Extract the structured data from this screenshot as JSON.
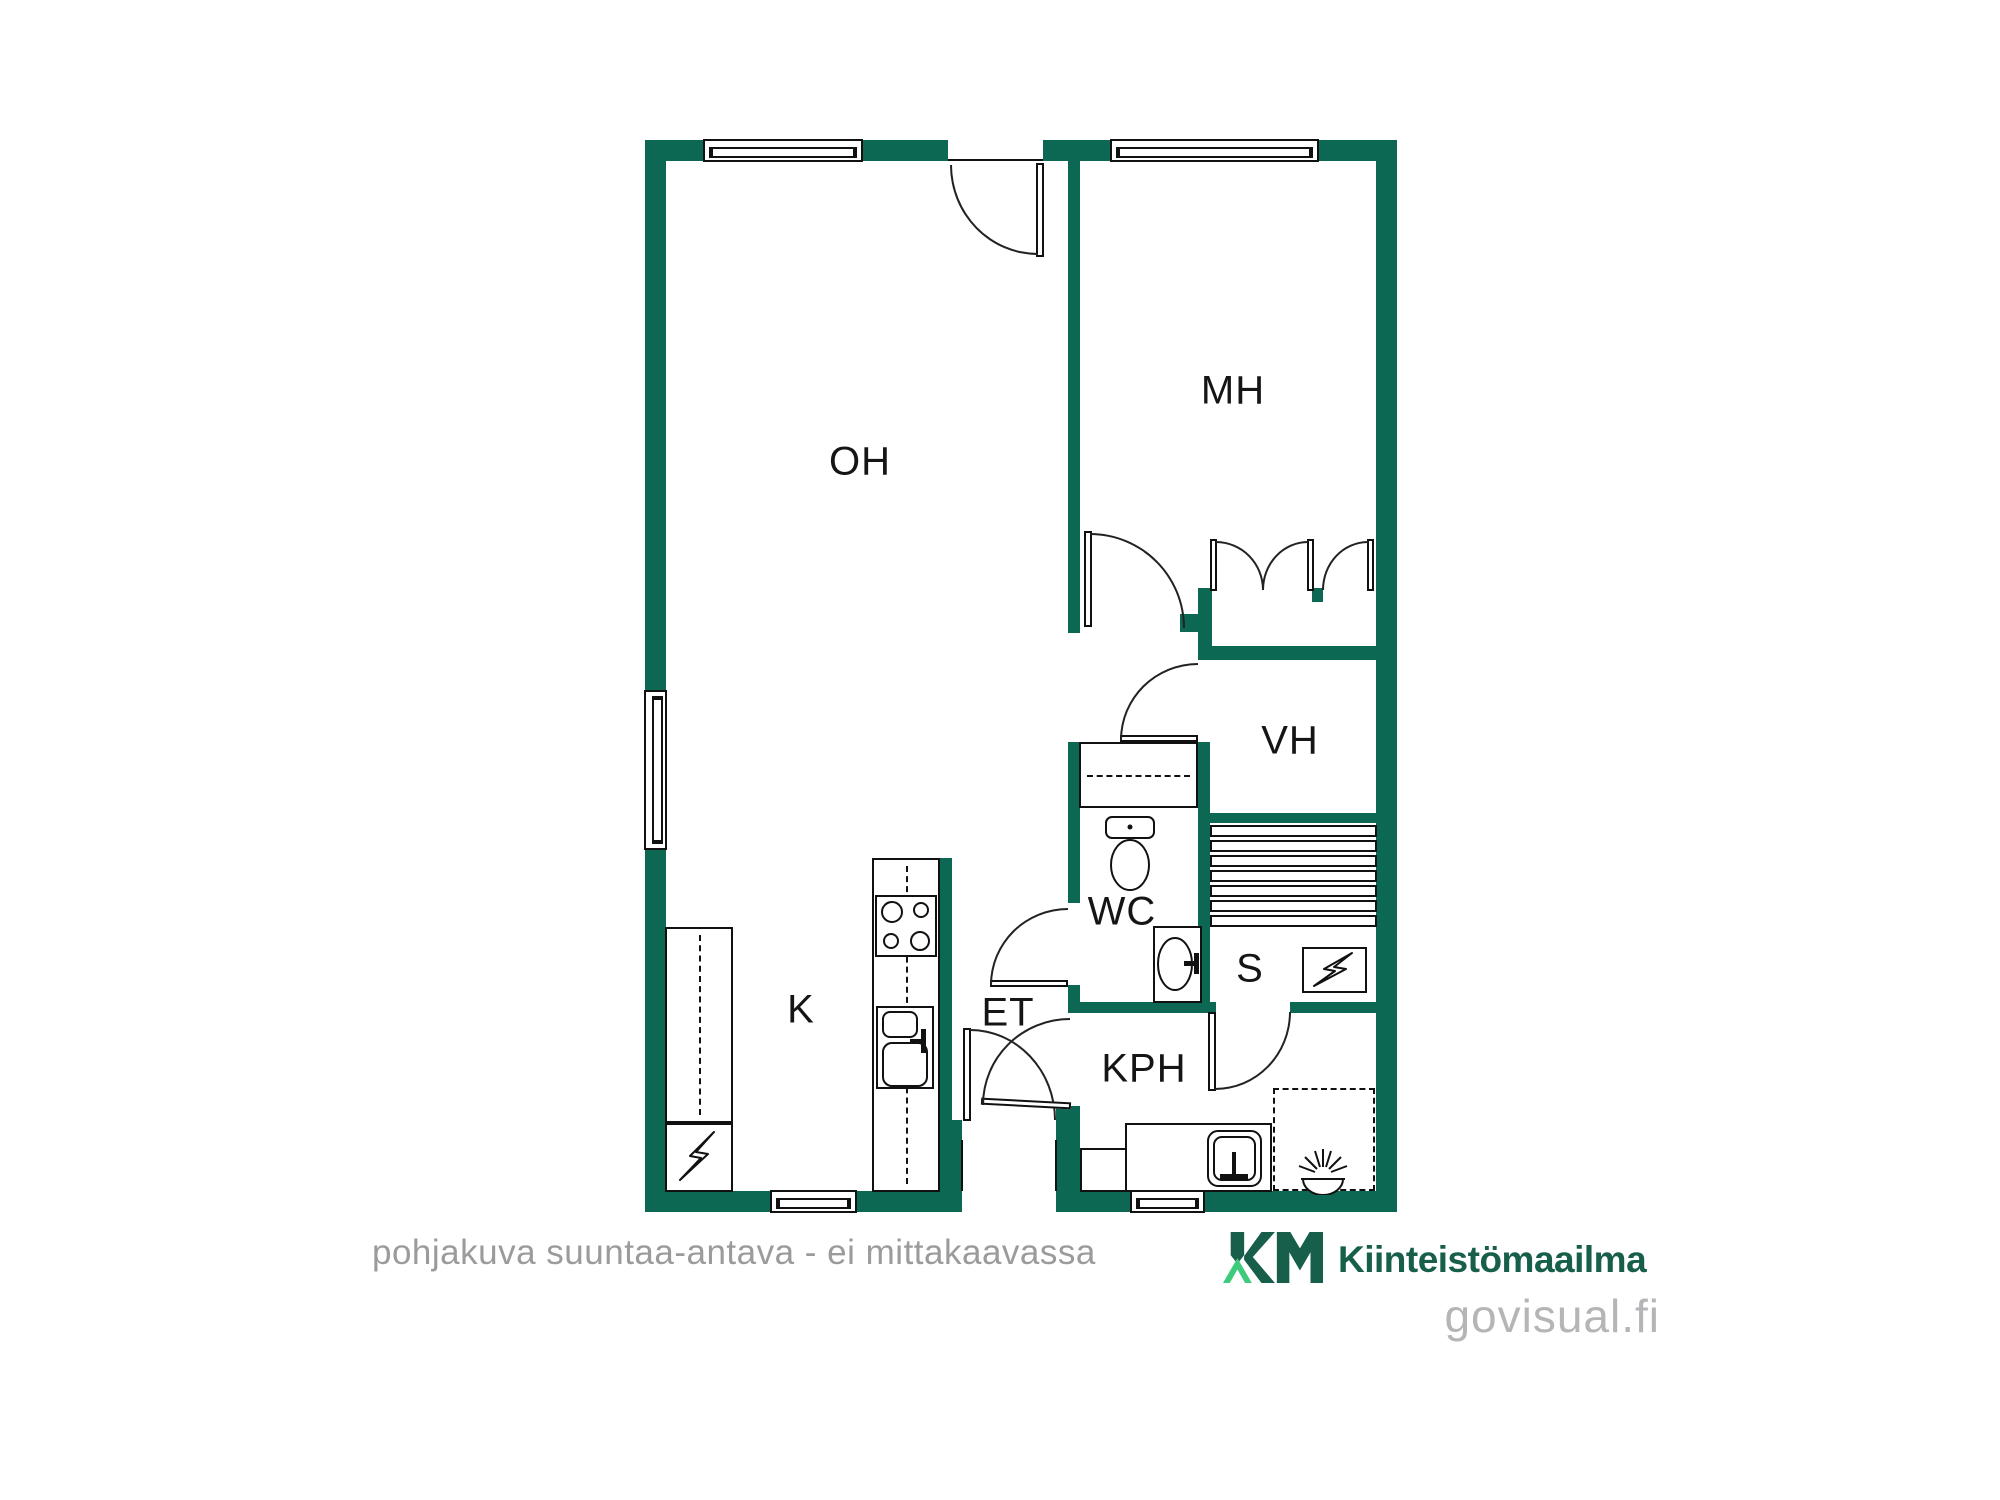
{
  "plan": {
    "rooms": {
      "oh": {
        "label": "OH"
      },
      "mh": {
        "label": "MH"
      },
      "vh": {
        "label": "VH"
      },
      "wc": {
        "label": "WC"
      },
      "s": {
        "label": "S"
      },
      "k": {
        "label": "K"
      },
      "et": {
        "label": "ET"
      },
      "kph": {
        "label": "KPH"
      }
    }
  },
  "footer": {
    "disclaimer": "pohjakuva suuntaa-antava - ei mittakaavassa"
  },
  "logo": {
    "mark": "KM",
    "name": "Kiinteistömaailma",
    "site": "govisual.fi"
  },
  "colors": {
    "wall_green": "#0d6853",
    "logo_dark_green": "#175e4b",
    "logo_mint_green": "#3fcb7d",
    "disclaimer_gray": "#9b9b9b",
    "site_gray": "#b5b5b8",
    "line_black": "#111111"
  },
  "icons": {
    "sauna_stove": "lightning-bolt",
    "kitchen_appliance": "lightning-bolt",
    "shower": "rays-over-dish"
  }
}
